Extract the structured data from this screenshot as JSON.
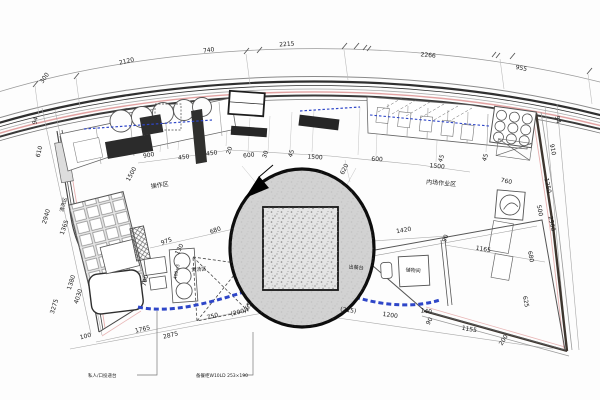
{
  "drawing_title": "kitchen-floor-plan",
  "colors": {
    "line": "#3a3a3a",
    "light_line": "#999999",
    "accent_pink": "#e2a2a2",
    "plumbing_blue": "#2e46c8",
    "wall_dark": "#3d352e",
    "equipment_dark": "#2b2b2b",
    "balloon_fill": "#d2d2d2",
    "balloon_square_fill": "#e4e4e4"
  },
  "dimensions": [
    {
      "t": "300",
      "x": 46,
      "y": 79,
      "r": -55
    },
    {
      "t": "2120",
      "x": 127,
      "y": 63,
      "r": -13
    },
    {
      "t": "740",
      "x": 209,
      "y": 52,
      "r": -9
    },
    {
      "t": "2215",
      "x": 287,
      "y": 46,
      "r": -4
    },
    {
      "t": "2266",
      "x": 428,
      "y": 57,
      "r": 6
    },
    {
      "t": "955",
      "x": 521,
      "y": 70,
      "r": 11
    },
    {
      "t": "94",
      "x": 37,
      "y": 121,
      "r": -78
    },
    {
      "t": "610",
      "x": 41,
      "y": 152,
      "r": -76
    },
    {
      "t": "2940",
      "x": 48,
      "y": 217,
      "r": -74
    },
    {
      "t": "1365",
      "x": 66,
      "y": 228,
      "r": -71
    },
    {
      "t": "1380",
      "x": 73,
      "y": 283,
      "r": -72
    },
    {
      "t": "4030",
      "x": 80,
      "y": 297,
      "r": -72
    },
    {
      "t": "3275",
      "x": 56,
      "y": 307,
      "r": -73
    },
    {
      "t": "900",
      "x": 149,
      "y": 157,
      "r": -10
    },
    {
      "t": "1500",
      "x": 133,
      "y": 175,
      "r": -62
    },
    {
      "t": "450",
      "x": 184,
      "y": 159,
      "r": -8
    },
    {
      "t": "450",
      "x": 212,
      "y": 155,
      "r": -8
    },
    {
      "t": "20",
      "x": 231,
      "y": 151,
      "r": -70
    },
    {
      "t": "600",
      "x": 249,
      "y": 157,
      "r": -6
    },
    {
      "t": "30",
      "x": 267,
      "y": 155,
      "r": -70
    },
    {
      "t": "45",
      "x": 293,
      "y": 154,
      "r": -72
    },
    {
      "t": "1500",
      "x": 315,
      "y": 159,
      "r": 3
    },
    {
      "t": "620",
      "x": 346,
      "y": 170,
      "r": -64
    },
    {
      "t": "600",
      "x": 377,
      "y": 161,
      "r": 3
    },
    {
      "t": "1500",
      "x": 437,
      "y": 168,
      "r": 6
    },
    {
      "t": "45",
      "x": 443,
      "y": 159,
      "r": -70
    },
    {
      "t": "45",
      "x": 487,
      "y": 158,
      "r": -72
    },
    {
      "t": "760",
      "x": 506,
      "y": 183,
      "r": 12
    },
    {
      "t": "975",
      "x": 167,
      "y": 243,
      "r": -19
    },
    {
      "t": "680",
      "x": 216,
      "y": 232,
      "r": -19
    },
    {
      "t": "130",
      "x": 181,
      "y": 250,
      "r": -62
    },
    {
      "t": "700",
      "x": 147,
      "y": 281,
      "r": -76
    },
    {
      "t": "1420",
      "x": 404,
      "y": 232,
      "r": -9
    },
    {
      "t": "90",
      "x": 447,
      "y": 239,
      "r": -68
    },
    {
      "t": "1165",
      "x": 483,
      "y": 251,
      "r": 9
    },
    {
      "t": "(215)",
      "x": 348,
      "y": 312,
      "r": 8
    },
    {
      "t": "1200",
      "x": 390,
      "y": 317,
      "r": 8
    },
    {
      "t": "140",
      "x": 426,
      "y": 313,
      "r": 8
    },
    {
      "t": "90",
      "x": 431,
      "y": 322,
      "r": -62
    },
    {
      "t": "1155",
      "x": 469,
      "y": 331,
      "r": 10
    },
    {
      "t": "200",
      "x": 505,
      "y": 341,
      "r": -58
    },
    {
      "t": "100",
      "x": 86,
      "y": 338,
      "r": -14
    },
    {
      "t": "1765",
      "x": 143,
      "y": 331,
      "r": -13
    },
    {
      "t": "2875",
      "x": 171,
      "y": 337,
      "r": -13
    },
    {
      "t": "750",
      "x": 213,
      "y": 318,
      "r": -14
    },
    {
      "t": "(200)",
      "x": 239,
      "y": 314,
      "r": -14
    },
    {
      "t": "65",
      "x": 250,
      "y": 307,
      "r": -62
    },
    {
      "t": "94",
      "x": 556,
      "y": 120,
      "r": 78
    },
    {
      "t": "910",
      "x": 551,
      "y": 150,
      "r": 78
    },
    {
      "t": "1250",
      "x": 546,
      "y": 186,
      "r": 78
    },
    {
      "t": "500",
      "x": 538,
      "y": 211,
      "r": 78
    },
    {
      "t": "2960",
      "x": 550,
      "y": 224,
      "r": 78
    },
    {
      "t": "680",
      "x": 529,
      "y": 257,
      "r": 78
    },
    {
      "t": "625",
      "x": 524,
      "y": 302,
      "r": 78
    }
  ],
  "area_labels": [
    {
      "t": "操作区",
      "x": 160,
      "y": 187,
      "r": -8,
      "s": 6
    },
    {
      "t": "内场作业区",
      "x": 441,
      "y": 185,
      "r": 5,
      "s": 6
    },
    {
      "t": "清洗区",
      "x": 65,
      "y": 205,
      "r": -76,
      "s": 5
    },
    {
      "t": "煲汤区",
      "x": 199,
      "y": 271,
      "r": -4,
      "s": 5
    },
    {
      "t": "出餐台",
      "x": 356,
      "y": 269,
      "r": 5,
      "s": 5
    },
    {
      "t": "储物间",
      "x": 413,
      "y": 272,
      "r": 5,
      "s": 5
    },
    {
      "t": "400×3",
      "x": 178,
      "y": 272,
      "r": -78,
      "s": 4.5
    }
  ],
  "callouts": [
    {
      "t": "私人/口投递台",
      "x": 88,
      "y": 377,
      "r": 0,
      "s": 4.5
    },
    {
      "t": "备餐柜W10LD 253×190",
      "x": 196,
      "y": 377,
      "r": 0,
      "s": 4.5
    }
  ]
}
